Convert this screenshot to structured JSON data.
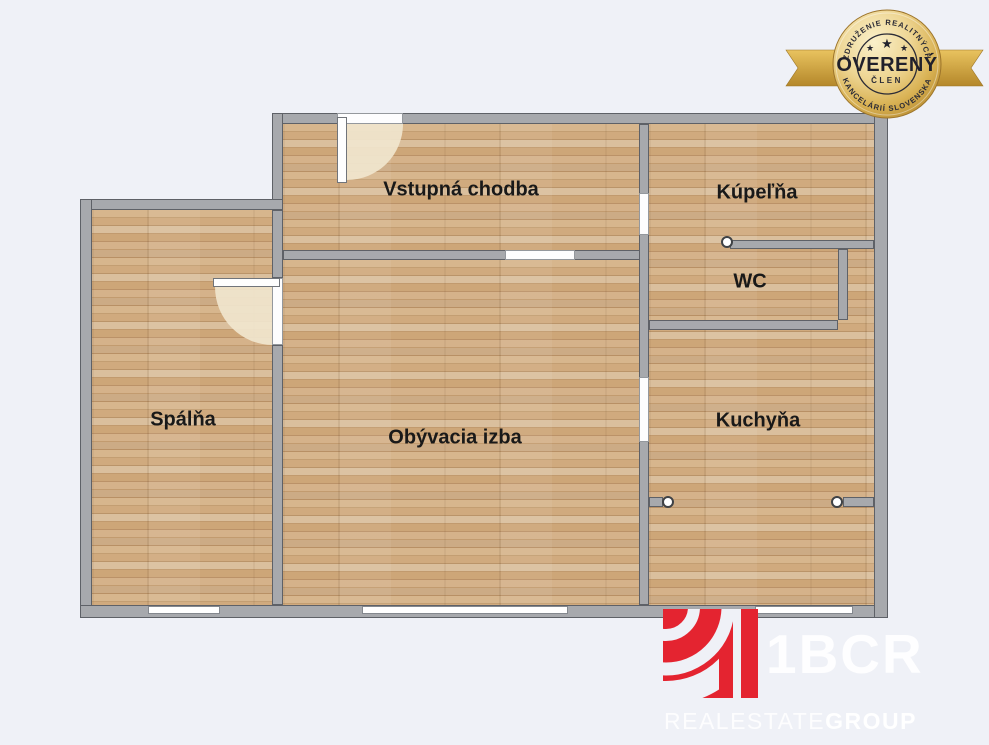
{
  "rooms": [
    {
      "label": "Spálňa"
    },
    {
      "label": "Obývacia izba"
    },
    {
      "label": "Vstupná chodba"
    },
    {
      "label": "Kúpeľňa"
    },
    {
      "label": "WC"
    },
    {
      "label": "Kuchyňa"
    }
  ],
  "badge": {
    "arc_top": "ZDRUŽENIE REALITNÝCH",
    "arc_bottom": "KANCELÁRIÍ SLOVENSKA",
    "title": "OVERENÝ",
    "subtitle": "ČLEN",
    "star": "★"
  },
  "logo": {
    "title": "1BCR",
    "words": [
      "REAL",
      "ESTATE",
      "GROUP"
    ]
  },
  "colors": {
    "background": "#eff1f7",
    "wall_gray": "#a7a9ad",
    "wood_floor": "#d1ac82",
    "badge_gold": "#d9b254",
    "badge_text_navy": "#2b2b36",
    "logo_red": "#e42430",
    "label_text": "#191919"
  }
}
